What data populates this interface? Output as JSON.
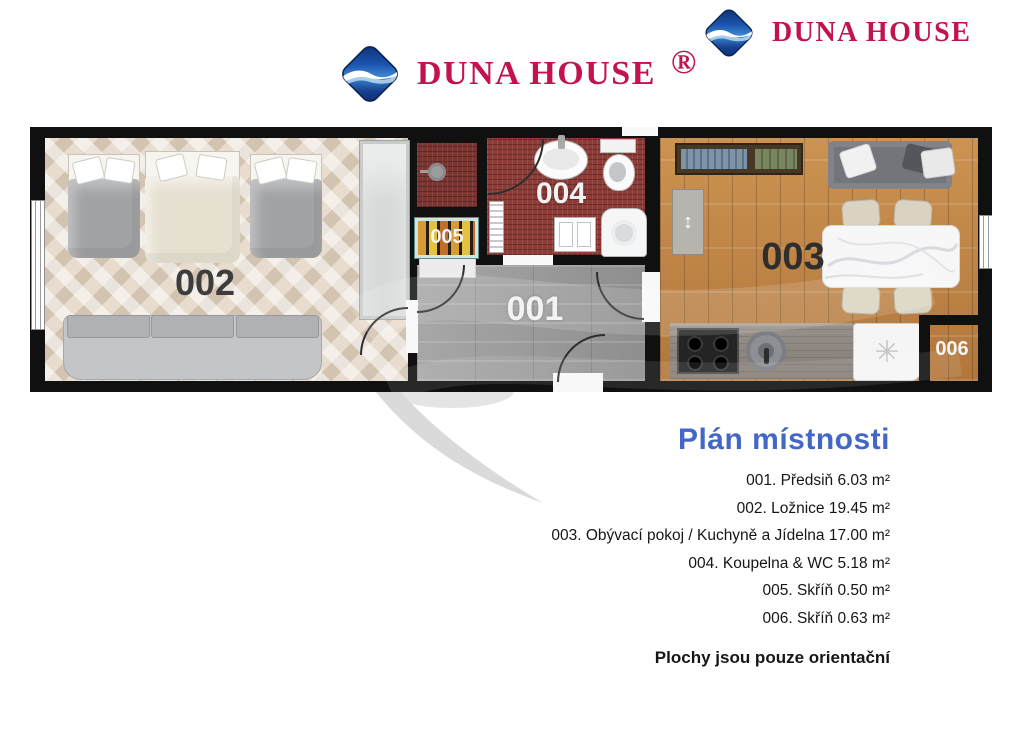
{
  "header": {
    "logo_center_text": "DUNA HOUSE",
    "logo_center_registered": "®",
    "logo_right_text": "DUNA HOUSE",
    "brand_red": "#c2124f",
    "logo_blue": "#0a2d6e"
  },
  "floorplan": {
    "labels": {
      "hallway": "001",
      "bedroom": "002",
      "living_kitchen": "003",
      "bathroom": "004",
      "closet_small": "005",
      "closet_corner": "006"
    },
    "icons": {
      "fridge_symbol": "✳",
      "bench_symbol": "↕"
    }
  },
  "legend": {
    "title": "Plán místnosti",
    "title_color": "#4366c9",
    "items": [
      {
        "text": "001. Předsiň 6.03 m²"
      },
      {
        "text": "002. Ložnice 19.45 m²"
      },
      {
        "text": "003. Obývací pokoj / Kuchyně a Jídelna 17.00 m²"
      },
      {
        "text": "004. Koupelna & WC 5.18 m²"
      },
      {
        "text": "005. Skříň 0.50 m²"
      },
      {
        "text": "006. Skříň 0.63 m²"
      }
    ],
    "footnote": "Plochy jsou pouze orientační"
  }
}
